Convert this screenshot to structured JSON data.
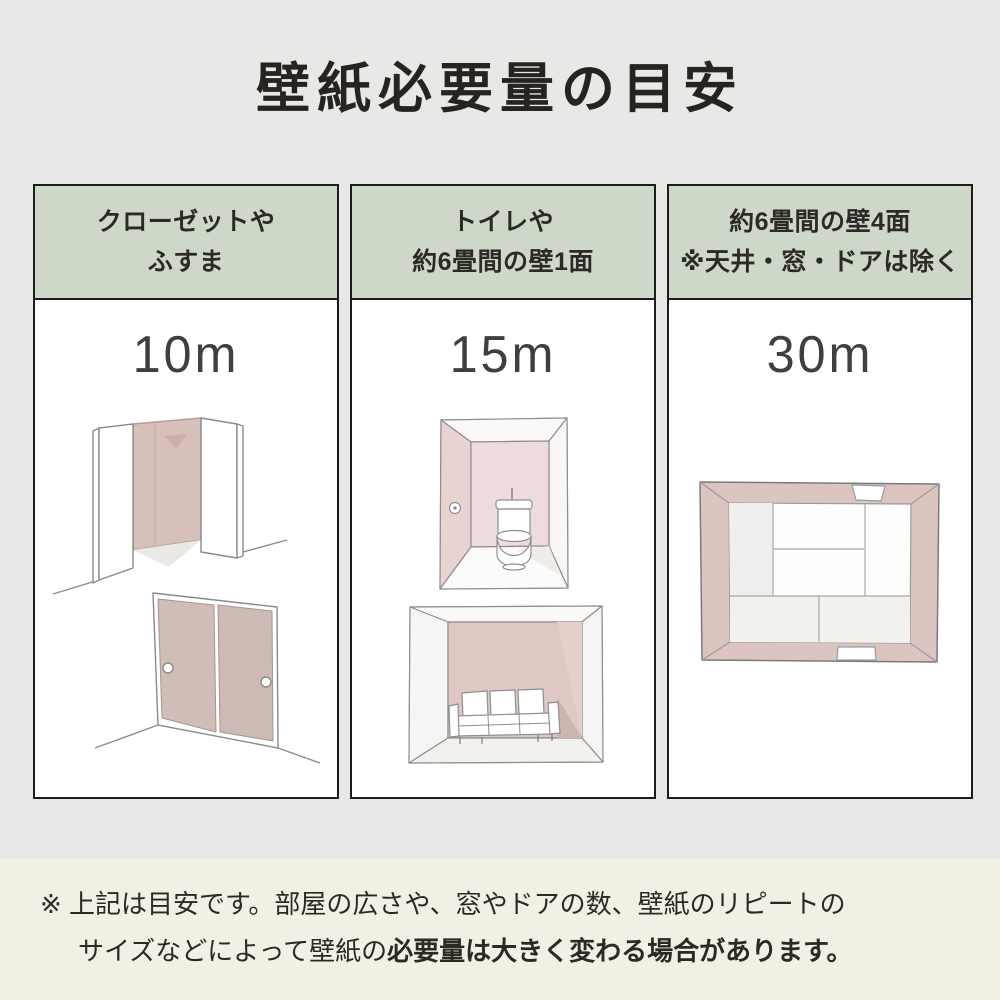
{
  "page": {
    "title": "壁紙必要量の目安",
    "background_color": "#e8e9e6",
    "note_background_color": "#f2efe5",
    "header_green": "#ced8c9",
    "wallpaper_pink": "#d8c0ba"
  },
  "columns": [
    {
      "header_line1": "クローゼットや",
      "header_line2": "ふすま",
      "value": "10m",
      "illustrations": [
        "open-closet",
        "fusuma-sliding-doors"
      ]
    },
    {
      "header_line1": "トイレや",
      "header_line2": "約6畳間の壁1面",
      "value": "15m",
      "illustrations": [
        "toilet-room",
        "room-one-accent-wall"
      ]
    },
    {
      "header_line1": "約6畳間の壁4面",
      "header_line2": "※天井・窓・ドアは除く",
      "value": "30m",
      "illustrations": [
        "tatami-room-four-walls"
      ]
    }
  ],
  "note": {
    "marker": "※",
    "line1": "上記は目安です。部屋の広さや、窓やドアの数、壁紙のリピートの",
    "line2_regular": "サイズなどによって壁紙の",
    "line2_bold": "必要量は大きく変わる場合があります。"
  }
}
